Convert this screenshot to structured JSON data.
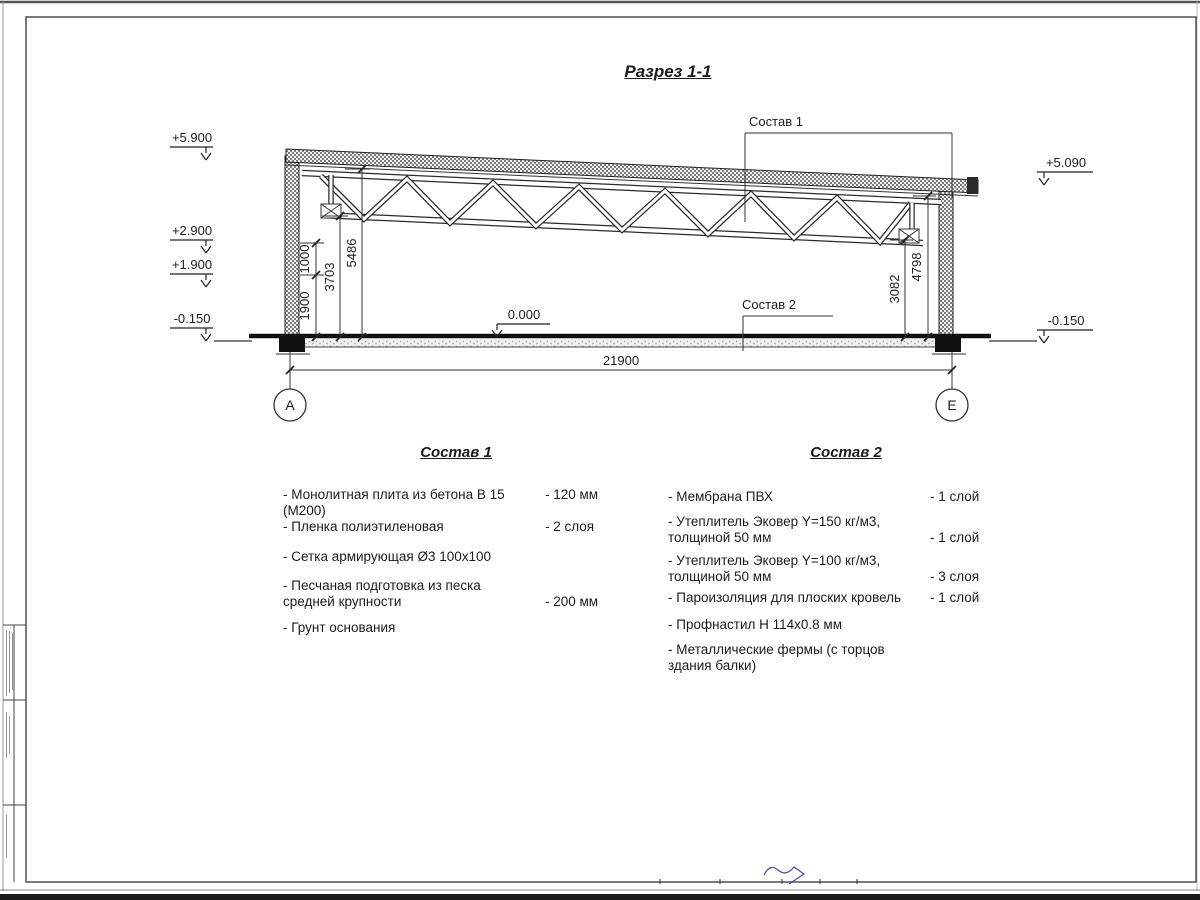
{
  "drawing_title": "Разрез 1-1",
  "annotations": {
    "sostav1_label": "Состав 1",
    "sostav2_label": "Состав 2",
    "zero_mark": "0.000"
  },
  "elevations": {
    "left": [
      "+5.900",
      "+2.900",
      "+1.900",
      "-0.150"
    ],
    "right": [
      "+5.090",
      "-0.150"
    ]
  },
  "dimensions": {
    "left_chain": [
      "1900",
      "1000",
      "3703",
      "5486"
    ],
    "right_chain": [
      "3082",
      "4798"
    ],
    "overall_span": "21900"
  },
  "axes": {
    "left": "А",
    "right": "Е"
  },
  "composition1": {
    "title": "Состав 1",
    "items": [
      {
        "name": "- Монолитная плита из бетона В 15 (М200)",
        "value": "- 120 мм"
      },
      {
        "name": "- Пленка полиэтиленовая",
        "value": "- 2 слоя"
      },
      {
        "name": "- Сетка армирующая Ø3 100х100",
        "value": ""
      },
      {
        "name": "- Песчаная подготовка из песка\nсредней крупности",
        "value": "- 200 мм"
      },
      {
        "name": "- Грунт основания",
        "value": ""
      }
    ]
  },
  "composition2": {
    "title": "Состав 2",
    "items": [
      {
        "name": "- Мембрана ПВХ",
        "value": "- 1 слой"
      },
      {
        "name": "- Утеплитель Эковер Y=150 кг/м3,\nтолщиной 50 мм",
        "value": "- 1 слой"
      },
      {
        "name": "- Утеплитель Эковер Y=100 кг/м3,\nтолщиной 50 мм",
        "value": "- 3 слоя"
      },
      {
        "name": "- Пароизоляция для плоских кровель",
        "value": "- 1 слой"
      },
      {
        "name": "- Профнастил Н 114х0.8 мм",
        "value": ""
      },
      {
        "name": "- Металлические фермы (с торцов здания балки)",
        "value": ""
      }
    ]
  }
}
